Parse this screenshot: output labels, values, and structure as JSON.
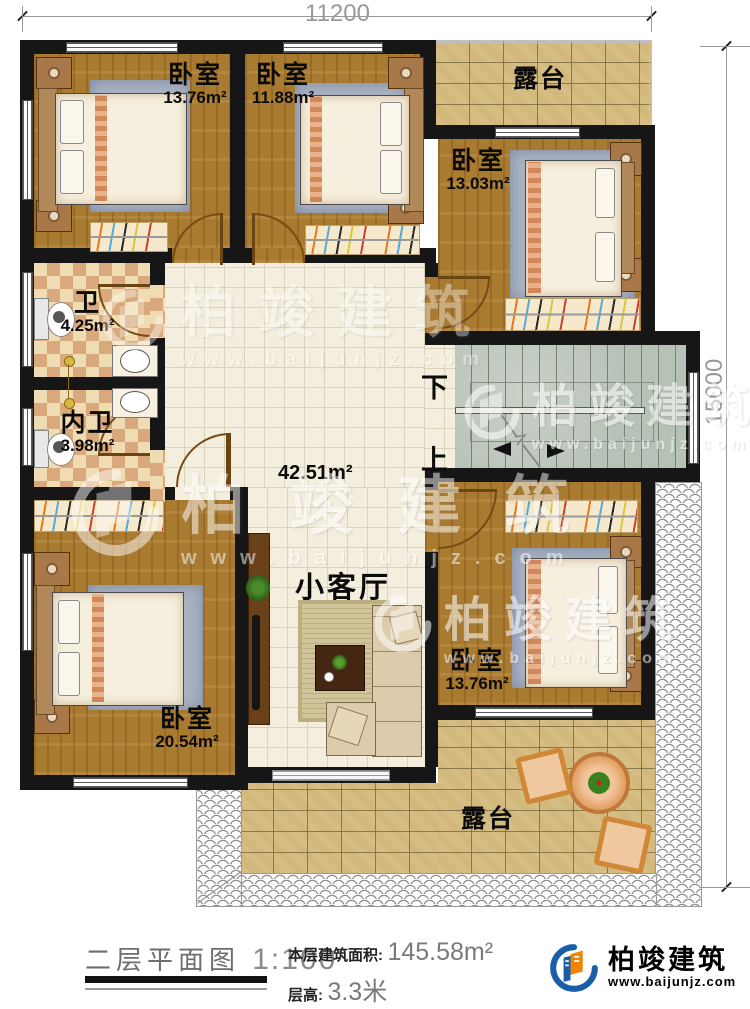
{
  "dimensions": {
    "width": "11200",
    "height": "15000"
  },
  "rooms": {
    "bedroom_top_left": {
      "name": "卧室",
      "area": "13.76m²"
    },
    "bedroom_top_mid": {
      "name": "卧室",
      "area": "11.88m²"
    },
    "bedroom_right": {
      "name": "卧室",
      "area": "13.03m²"
    },
    "bathroom": {
      "name": "卫",
      "area": "4.25m²"
    },
    "inner_bathroom": {
      "name": "内卫",
      "area": "3.98m²"
    },
    "hall": {
      "area": "42.51m²",
      "living_label": "小客厅"
    },
    "bedroom_bottom_left": {
      "name": "卧室",
      "area": "20.54m²"
    },
    "bedroom_bottom_right": {
      "name": "卧室",
      "area": "13.76m²"
    },
    "terrace_top": {
      "name": "露台"
    },
    "terrace_bottom": {
      "name": "露台"
    },
    "stairs": {
      "down": "下",
      "up": "上"
    }
  },
  "watermark": {
    "text": "柏竣建筑",
    "url": "www.baijunjz.com"
  },
  "footer": {
    "title": "二层平面图",
    "scale": "1:100",
    "area_label": "本层建筑面积:",
    "area_value": "145.58m²",
    "floor_height_label": "层高:",
    "floor_height_value": "3.3米",
    "brand_name": "柏竣建筑",
    "brand_url": "www.baijunjz.com"
  },
  "colors": {
    "brand_blue": "#1b5ea8",
    "brand_orange": "#f08300",
    "wall": "#161616"
  }
}
